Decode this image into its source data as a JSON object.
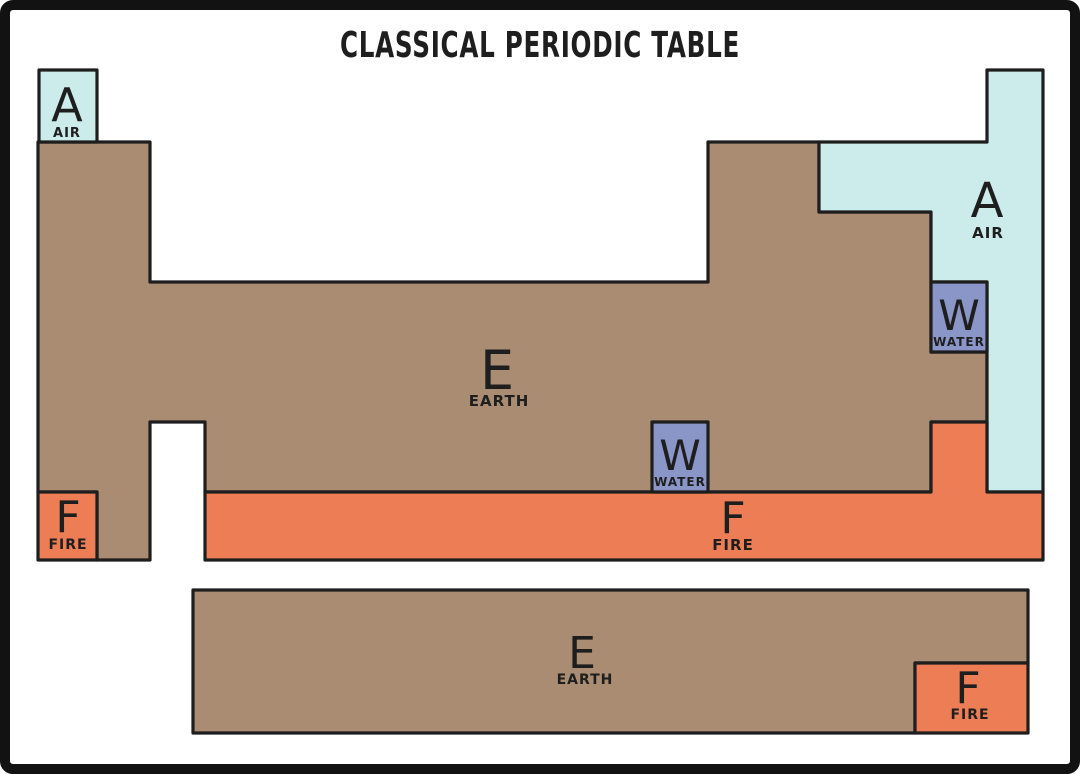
{
  "title": "CLASSICAL PERIODIC TABLE",
  "colors": {
    "air": "#cbecea",
    "earth": "#a98c72",
    "fire": "#ec7d55",
    "water": "#8b96c8",
    "paper": "#ffffff",
    "ink": "#1e1e1e"
  },
  "regions": {
    "hydrogen_air": {
      "symbol": "A",
      "label": "AIR"
    },
    "main_air": {
      "symbol": "A",
      "label": "AIR"
    },
    "main_earth": {
      "symbol": "E",
      "label": "EARTH"
    },
    "bromine_water": {
      "symbol": "W",
      "label": "WATER"
    },
    "mercury_water": {
      "symbol": "W",
      "label": "WATER"
    },
    "francium_fire": {
      "symbol": "F",
      "label": "FIRE"
    },
    "period7_fire": {
      "symbol": "F",
      "label": "FIRE"
    },
    "fblock_earth": {
      "symbol": "E",
      "label": "EARTH"
    },
    "fblock_fire": {
      "symbol": "F",
      "label": "FIRE"
    }
  }
}
